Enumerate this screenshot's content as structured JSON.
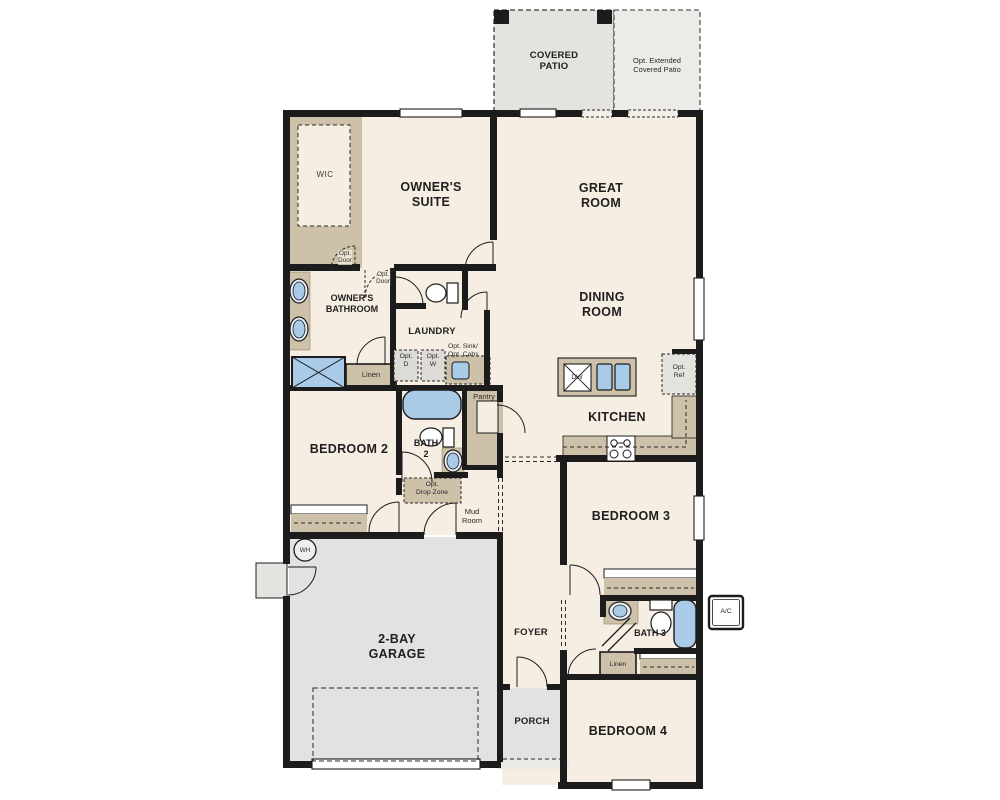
{
  "rooms": {
    "covered_patio": [
      "COVERED",
      "PATIO"
    ],
    "opt_extended_patio": [
      "Opt. Extended",
      "Covered Patio"
    ],
    "wic": [
      "WIC"
    ],
    "owners_suite": [
      "OWNER'S",
      "SUITE"
    ],
    "great_room": [
      "GREAT",
      "ROOM"
    ],
    "dining_room": [
      "DINING",
      "ROOM"
    ],
    "owners_bathroom": [
      "OWNER'S",
      "BATHROOM"
    ],
    "laundry": [
      "LAUNDRY"
    ],
    "kitchen": [
      "KITCHEN"
    ],
    "pantry": [
      "Pantry"
    ],
    "bedroom_2": [
      "BEDROOM 2"
    ],
    "bath_2": [
      "BATH",
      "2"
    ],
    "mud_room": [
      "Mud",
      "Room"
    ],
    "bedroom_3": [
      "BEDROOM 3"
    ],
    "bath_3": [
      "BATH 3"
    ],
    "bedroom_4": [
      "BEDROOM 4"
    ],
    "foyer": [
      "FOYER"
    ],
    "porch": [
      "PORCH"
    ],
    "garage": [
      "2-BAY",
      "GARAGE"
    ]
  },
  "annotations": {
    "opt_door_wic": [
      "Opt.",
      "Door"
    ],
    "opt_door_suite": [
      "Opt.",
      "Door"
    ],
    "opt_dryer": [
      "Opt.",
      "D"
    ],
    "opt_washer": [
      "Opt.",
      "W"
    ],
    "opt_sink_cabs": [
      "Opt. Sink/",
      "Opt. Cabs"
    ],
    "linen_hall": [
      "Linen"
    ],
    "opt_ref": [
      "Opt.",
      "Ref"
    ],
    "opt_drop_zone": [
      "Opt.",
      "Drop Zone"
    ],
    "linen_bath3": [
      "Linen"
    ],
    "dishwasher": [
      "DW"
    ],
    "water_heater": [
      "WH"
    ],
    "ac_unit": [
      "A/C"
    ]
  },
  "colors": {
    "wall": "#1c1c1c",
    "room_fill": "#f6eee2",
    "cabinet_tan": "#cdc1a9",
    "garage_fill": "#e2e2e2",
    "patio_fill": "#e4e3df",
    "fixture_blue": "#a9cbe8"
  }
}
